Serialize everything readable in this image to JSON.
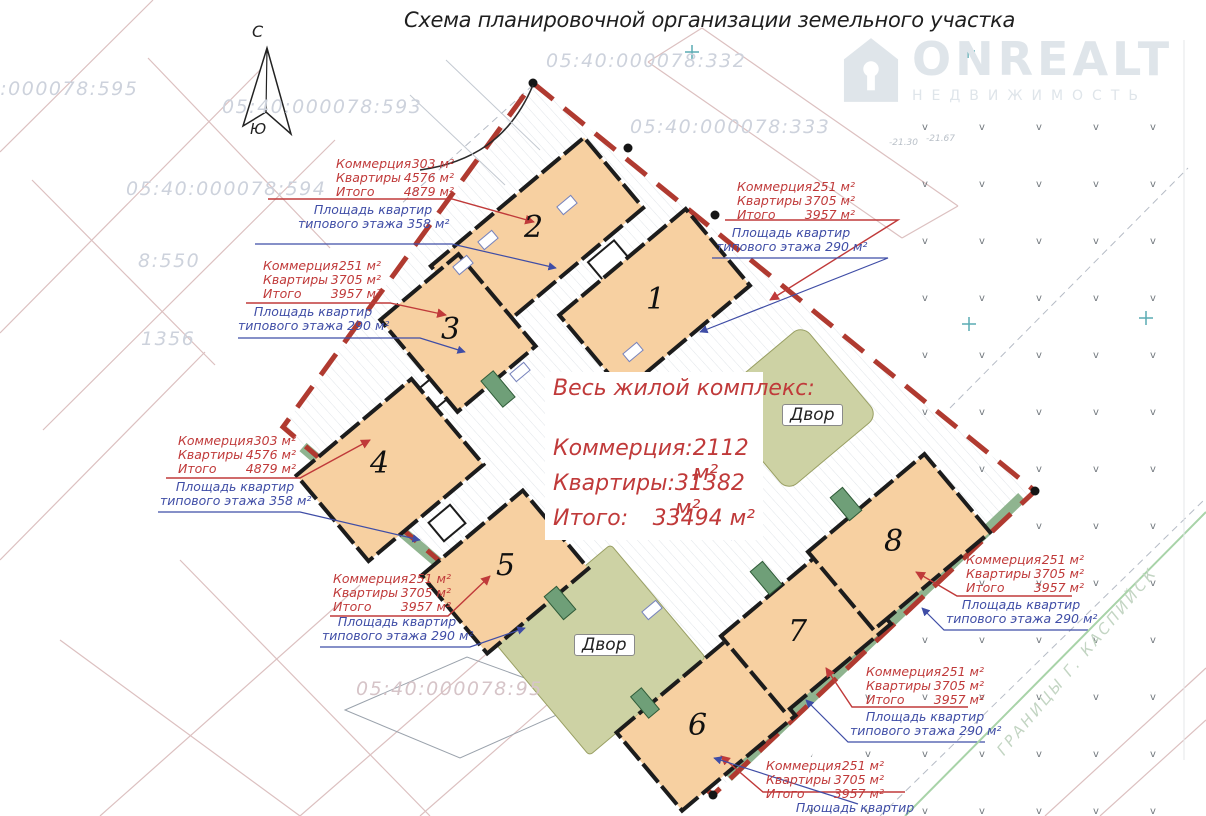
{
  "title": "Схема планировочной организации земельного участка",
  "watermark": {
    "brand": "ONREALT",
    "tagline": "НЕДВИЖИМОСТЬ"
  },
  "compass": {
    "north": "С",
    "south": "Ю"
  },
  "summary": {
    "heading": "Весь жилой комплекс:",
    "commerce_label": "Коммерция:",
    "commerce_value": "2112 м²",
    "apartments_label": "Квартиры:",
    "apartments_value": "31382 м²",
    "total_label": "Итого:",
    "total_value": "33494 м²"
  },
  "courtyards": [
    {
      "label": "Двор"
    },
    {
      "label": "Двор"
    }
  ],
  "buildings": [
    {
      "number": "1"
    },
    {
      "number": "2"
    },
    {
      "number": "3"
    },
    {
      "number": "4"
    },
    {
      "number": "5"
    },
    {
      "number": "6"
    },
    {
      "number": "7"
    },
    {
      "number": "8"
    }
  ],
  "annotation_labels": {
    "commerce": "Коммерция",
    "apartments": "Квартиры",
    "total": "Итого",
    "floor_line1": "Площадь квартир",
    "floor_line2": "типового этажа"
  },
  "annotations": [
    {
      "building": "2",
      "commerce": "303 м²",
      "apartments": "4576 м²",
      "total": "4879 м²",
      "typical_floor": "358 м²"
    },
    {
      "building": "3",
      "commerce": "251 м²",
      "apartments": "3705 м²",
      "total": "3957 м²",
      "typical_floor": "290 м²"
    },
    {
      "building": "4",
      "commerce": "303 м²",
      "apartments": "4576 м²",
      "total": "4879 м²",
      "typical_floor": "358 м²"
    },
    {
      "building": "5",
      "commerce": "251 м²",
      "apartments": "3705 м²",
      "total": "3957 м²",
      "typical_floor": "290 м²"
    },
    {
      "building": "1",
      "commerce": "251 м²",
      "apartments": "3705 м²",
      "total": "3957 м²",
      "typical_floor": "290 м²"
    },
    {
      "building": "8",
      "commerce": "251 м²",
      "apartments": "3705 м²",
      "total": "3957 м²",
      "typical_floor": "290 м²"
    },
    {
      "building": "7",
      "commerce": "251 м²",
      "apartments": "3705 м²",
      "total": "3957 м²",
      "typical_floor": "290 м²"
    },
    {
      "building": "6",
      "commerce": "251 м²",
      "apartments": "3705 м²",
      "total": "3957 м²",
      "typical_floor": "290 м²"
    }
  ],
  "cadastral_numbers": [
    "05:40:000078:595",
    "05:40:000078:593",
    "05:40:000078:594",
    "8:550",
    "1356",
    "05:40:000078:332",
    "05:40:000078:333",
    "05:40:000078:95"
  ],
  "city_boundary_label": "ГРАНИЦЫ Г. КАСПИЙСК",
  "elevation_marks": [
    "-21.30",
    "-21.67"
  ]
}
